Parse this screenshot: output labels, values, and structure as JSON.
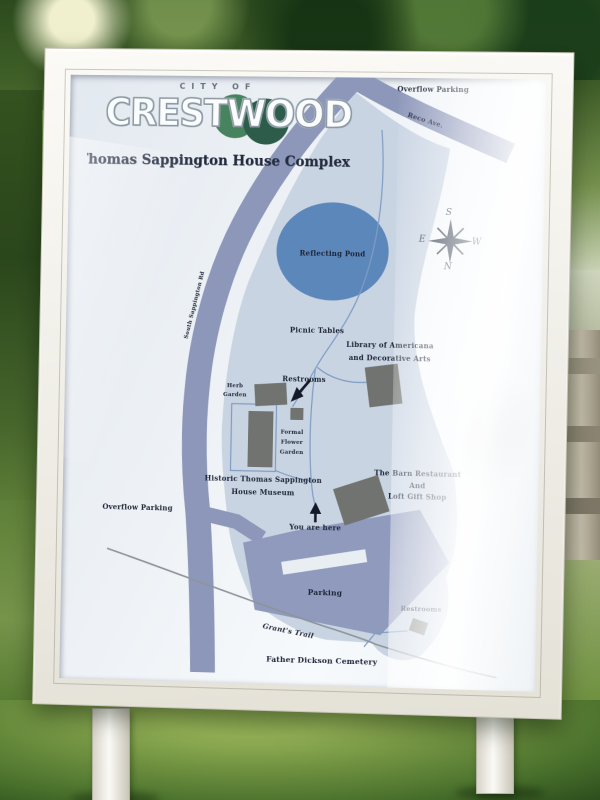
{
  "logo": {
    "city_of": "CITY OF",
    "name": "CRESTWOOD"
  },
  "title": "Thomas Sappington House Complex",
  "map": {
    "labels": {
      "overflow_parking_top": "Overflow Parking",
      "reco_ave": "Reco Ave.",
      "sappington_rd": "South Sappington Rd",
      "reflecting_pond": "Reflecting Pond",
      "picnic_tables": "Picnic Tables",
      "library_line1": "Library of Americana",
      "library_line2": "and Decorative Arts",
      "restrooms_center": "Restrooms",
      "herb_line1": "Herb",
      "herb_line2": "Garden",
      "formal_line1": "Formal",
      "formal_line2": "Flower",
      "formal_line3": "Garden",
      "museum_line1": "Historic Thomas Sappington",
      "museum_line2": "House Museum",
      "barn_line1": "The Barn Restaurant",
      "barn_line2": "And",
      "barn_line3": "Loft Gift Shop",
      "you_are_here": "You are here",
      "overflow_parking_left": "Overflow Parking",
      "parking": "Parking",
      "restrooms_bottom": "Restrooms",
      "grants_trail": "Grant's Trail",
      "cemetery": "Father Dickson Cemetery"
    },
    "compass": {
      "north": "N",
      "south": "S",
      "east": "E",
      "west": "W"
    },
    "colors": {
      "road": "#8d97ba",
      "site_area": "#c9d4e3",
      "pond": "#5c87bb",
      "building": "#70736f",
      "parking": "#8f9abd",
      "path": "#7f9cc4",
      "trail": "#8e939b",
      "label_text": "#1c2436",
      "logo_green_light": "#47835f",
      "logo_green_dark": "#2d5c4a"
    }
  }
}
